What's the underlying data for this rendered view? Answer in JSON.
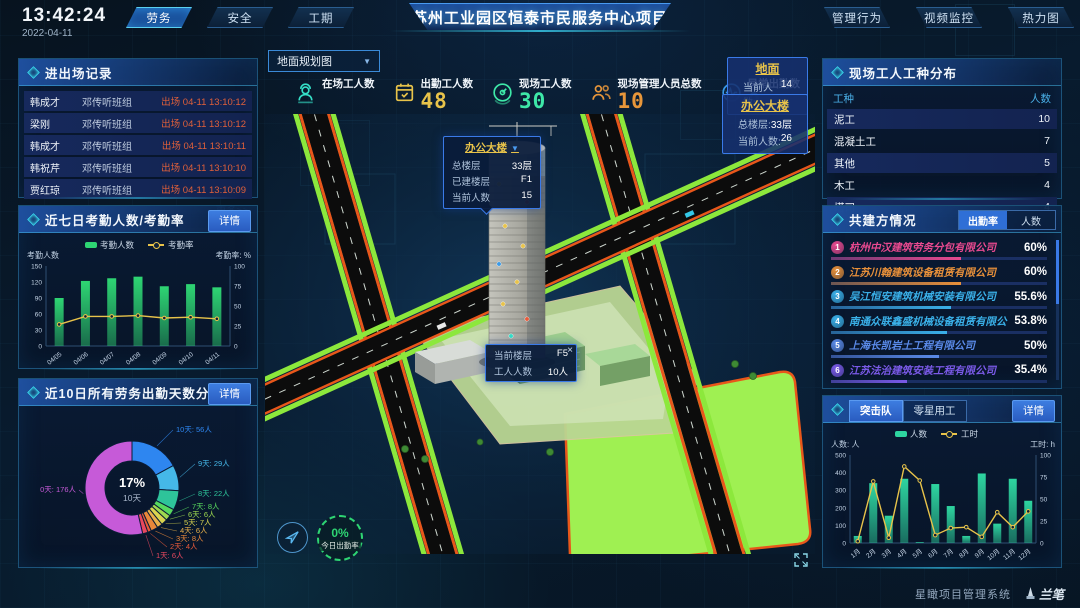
{
  "topbar": {
    "time": "13:42:24",
    "date": "2022-04-11",
    "left_tabs": [
      {
        "label": "劳务",
        "active": true
      },
      {
        "label": "安全",
        "active": false
      },
      {
        "label": "工期",
        "active": false
      }
    ],
    "title": "苏州工业园区恒泰市民服务中心项目",
    "right_tabs": [
      {
        "label": "管理行为"
      },
      {
        "label": "视频监控"
      },
      {
        "label": "热力图"
      }
    ]
  },
  "colors": {
    "accent": "#35d8e8",
    "button_blue": "#2f6fd6",
    "bar_green": "#2ed573",
    "line_yellow": "#e8c34a",
    "exit_red": "#e0603a",
    "link_blue": "#3aa0ff"
  },
  "entry_exit_panel": {
    "title": "进出场记录",
    "more_label": "更多>>",
    "records": [
      {
        "name": "韩成才",
        "team": "邓传听班组",
        "event": "出场 04-11 13:10:12"
      },
      {
        "name": "梁刚",
        "team": "邓传听班组",
        "event": "出场 04-11 13:10:12"
      },
      {
        "name": "韩成才",
        "team": "邓传听班组",
        "event": "出场 04-11 13:10:11"
      },
      {
        "name": "韩祝芹",
        "team": "邓传听班组",
        "event": "出场 04-11 13:10:10"
      },
      {
        "name": "贾红琼",
        "team": "邓传听班组",
        "event": "出场 04-11 13:10:09"
      }
    ]
  },
  "attendance_panel": {
    "title": "近七日考勤人数/考勤率",
    "detail_label": "详情"
  },
  "distribution_panel": {
    "title": "近10日所有劳务出勤天数分布",
    "detail_label": "详情"
  },
  "map": {
    "layer_select": "地面规划图",
    "stats": [
      {
        "icon": "worker-icon",
        "label": "在场工人数",
        "value": ""
      },
      {
        "icon": "calendar-check-icon",
        "label": "出勤工人数",
        "value": "48"
      },
      {
        "icon": "gauge-icon",
        "label": "现场工人数",
        "value": "30"
      },
      {
        "icon": "people-icon",
        "label": "现场管理人员总数",
        "value": "10"
      },
      {
        "icon": "pulse-icon",
        "label": "异常出勤数",
        "value": "0"
      }
    ],
    "building_tooltip": {
      "title": "办公大楼",
      "rows": [
        {
          "label": "总楼层",
          "value": "33层"
        },
        {
          "label": "已建楼层",
          "value": "F1"
        },
        {
          "label": "当前人数",
          "value": "15"
        }
      ]
    },
    "floor_tooltip": {
      "close": "×",
      "rows": [
        {
          "label": "当前楼层",
          "value": "F5"
        },
        {
          "label": "工人人数",
          "value": "10人"
        }
      ]
    },
    "ground_box": {
      "title": "地面",
      "rows": [
        {
          "label": "当前人数:",
          "value": "14"
        }
      ]
    },
    "building_box": {
      "title": "办公大楼",
      "rows": [
        {
          "label": "总楼层:",
          "value": "33层"
        },
        {
          "label": "当前人数:",
          "value": "26"
        }
      ]
    },
    "gauge": {
      "value": "0%",
      "label": "今日出勤率"
    }
  },
  "worker_type_panel": {
    "title": "现场工人工种分布",
    "columns": [
      "工种",
      "人数"
    ],
    "rows": [
      [
        "泥工",
        "10"
      ],
      [
        "混凝土工",
        "7"
      ],
      [
        "其他",
        "5"
      ],
      [
        "木工",
        "4"
      ],
      [
        "塔司",
        "4"
      ]
    ]
  },
  "partners_panel": {
    "title": "共建方情况",
    "tabs": [
      {
        "label": "出勤率",
        "active": true
      },
      {
        "label": "人数",
        "active": false
      }
    ],
    "companies": [
      {
        "rank": "1",
        "name": "杭州中汉建筑劳务分包有限公司",
        "value": "60%",
        "pct": 60,
        "color": "#e8498f"
      },
      {
        "rank": "2",
        "name": "江苏川翰建筑设备租赁有限公司",
        "value": "60%",
        "pct": 60,
        "color": "#e8903a"
      },
      {
        "rank": "3",
        "name": "吴江恒安建筑机械安装有限公司",
        "value": "55.6%",
        "pct": 55.6,
        "color": "#3ab0e8"
      },
      {
        "rank": "4",
        "name": "南通众联鑫盛机械设备租赁有限公司",
        "value": "53.8%",
        "pct": 53.8,
        "color": "#3ab0e8"
      },
      {
        "rank": "5",
        "name": "上海长凯岩土工程有限公司",
        "value": "50%",
        "pct": 50,
        "color": "#5a8ae8"
      },
      {
        "rank": "6",
        "name": "江苏法治建筑安装工程有限公司",
        "value": "35.4%",
        "pct": 35.4,
        "color": "#7a5ae8"
      }
    ]
  },
  "assault_panel": {
    "tabs": [
      {
        "label": "突击队",
        "active": true
      },
      {
        "label": "零星用工",
        "active": false
      }
    ],
    "detail_label": "详情"
  },
  "footer": {
    "brand": "星瞰项目管理系统",
    "logo": "兰笔"
  },
  "chart_data": [
    {
      "id": "attendance",
      "type": "bar",
      "title": "近七日考勤人数/考勤率",
      "categories": [
        "04/05",
        "04/06",
        "04/07",
        "04/08",
        "04/09",
        "04/10",
        "04/11"
      ],
      "series": [
        {
          "name": "考勤人数",
          "type": "bar",
          "axis": "left",
          "color": "#2ed573",
          "values": [
            90,
            122,
            127,
            130,
            112,
            116,
            110
          ]
        },
        {
          "name": "考勤率",
          "type": "line",
          "axis": "right",
          "color": "#e8c34a",
          "values": [
            27,
            37,
            37,
            38,
            35,
            36,
            34
          ]
        }
      ],
      "left_axis": {
        "label": "考勤人数",
        "min": 0,
        "max": 150,
        "ticks": [
          0,
          30,
          60,
          90,
          120,
          150
        ]
      },
      "right_axis": {
        "label": "考勤率: %",
        "min": 0,
        "max": 100,
        "ticks": [
          0,
          25,
          50,
          75,
          100
        ]
      },
      "grid": false,
      "legend_position": "top"
    },
    {
      "id": "distribution",
      "type": "pie",
      "title": "近10日所有劳务出勤天数分布",
      "center": {
        "value": "17%",
        "label": "10天"
      },
      "slices": [
        {
          "label": "10天",
          "people": "56人",
          "value": 56,
          "color": "#2e86f0"
        },
        {
          "label": "9天",
          "people": "29人",
          "value": 29,
          "color": "#45b8e8"
        },
        {
          "label": "8天",
          "people": "22人",
          "value": 22,
          "color": "#2ec49a"
        },
        {
          "label": "7天",
          "people": "8人",
          "value": 8,
          "color": "#57d95e"
        },
        {
          "label": "6天",
          "people": "6人",
          "value": 6,
          "color": "#9ed94f"
        },
        {
          "label": "5天",
          "people": "7人",
          "value": 7,
          "color": "#d9d44f"
        },
        {
          "label": "4天",
          "people": "6人",
          "value": 6,
          "color": "#e8b04a"
        },
        {
          "label": "3天",
          "people": "8人",
          "value": 8,
          "color": "#e8873a"
        },
        {
          "label": "2天",
          "people": "4人",
          "value": 4,
          "color": "#e85a3a"
        },
        {
          "label": "1天",
          "people": "6人",
          "value": 6,
          "color": "#e8485f"
        },
        {
          "label": "0天",
          "people": "176人",
          "value": 176,
          "color": "#c65ad8"
        }
      ]
    },
    {
      "id": "assault",
      "type": "bar",
      "categories": [
        "1月",
        "2月",
        "3月",
        "4月",
        "5月",
        "6月",
        "7月",
        "8月",
        "9月",
        "10月",
        "11月",
        "12月"
      ],
      "series": [
        {
          "name": "人数",
          "type": "bar",
          "axis": "left",
          "color": "#2ed5a0",
          "values": [
            40,
            340,
            155,
            365,
            5,
            335,
            210,
            40,
            395,
            110,
            365,
            240
          ]
        },
        {
          "name": "工时",
          "type": "line",
          "axis": "right",
          "color": "#e8c34a",
          "values": [
            2,
            70,
            6,
            87,
            71,
            9,
            17,
            18,
            7,
            35,
            18,
            36
          ]
        }
      ],
      "left_axis": {
        "label": "人数: 人",
        "min": 0,
        "max": 500,
        "ticks": [
          0,
          100,
          200,
          300,
          400,
          500
        ]
      },
      "right_axis": {
        "label": "工时: h",
        "min": 0,
        "max": 100,
        "ticks": [
          0,
          25,
          50,
          75,
          100
        ]
      },
      "grid": false,
      "legend_position": "top"
    }
  ]
}
